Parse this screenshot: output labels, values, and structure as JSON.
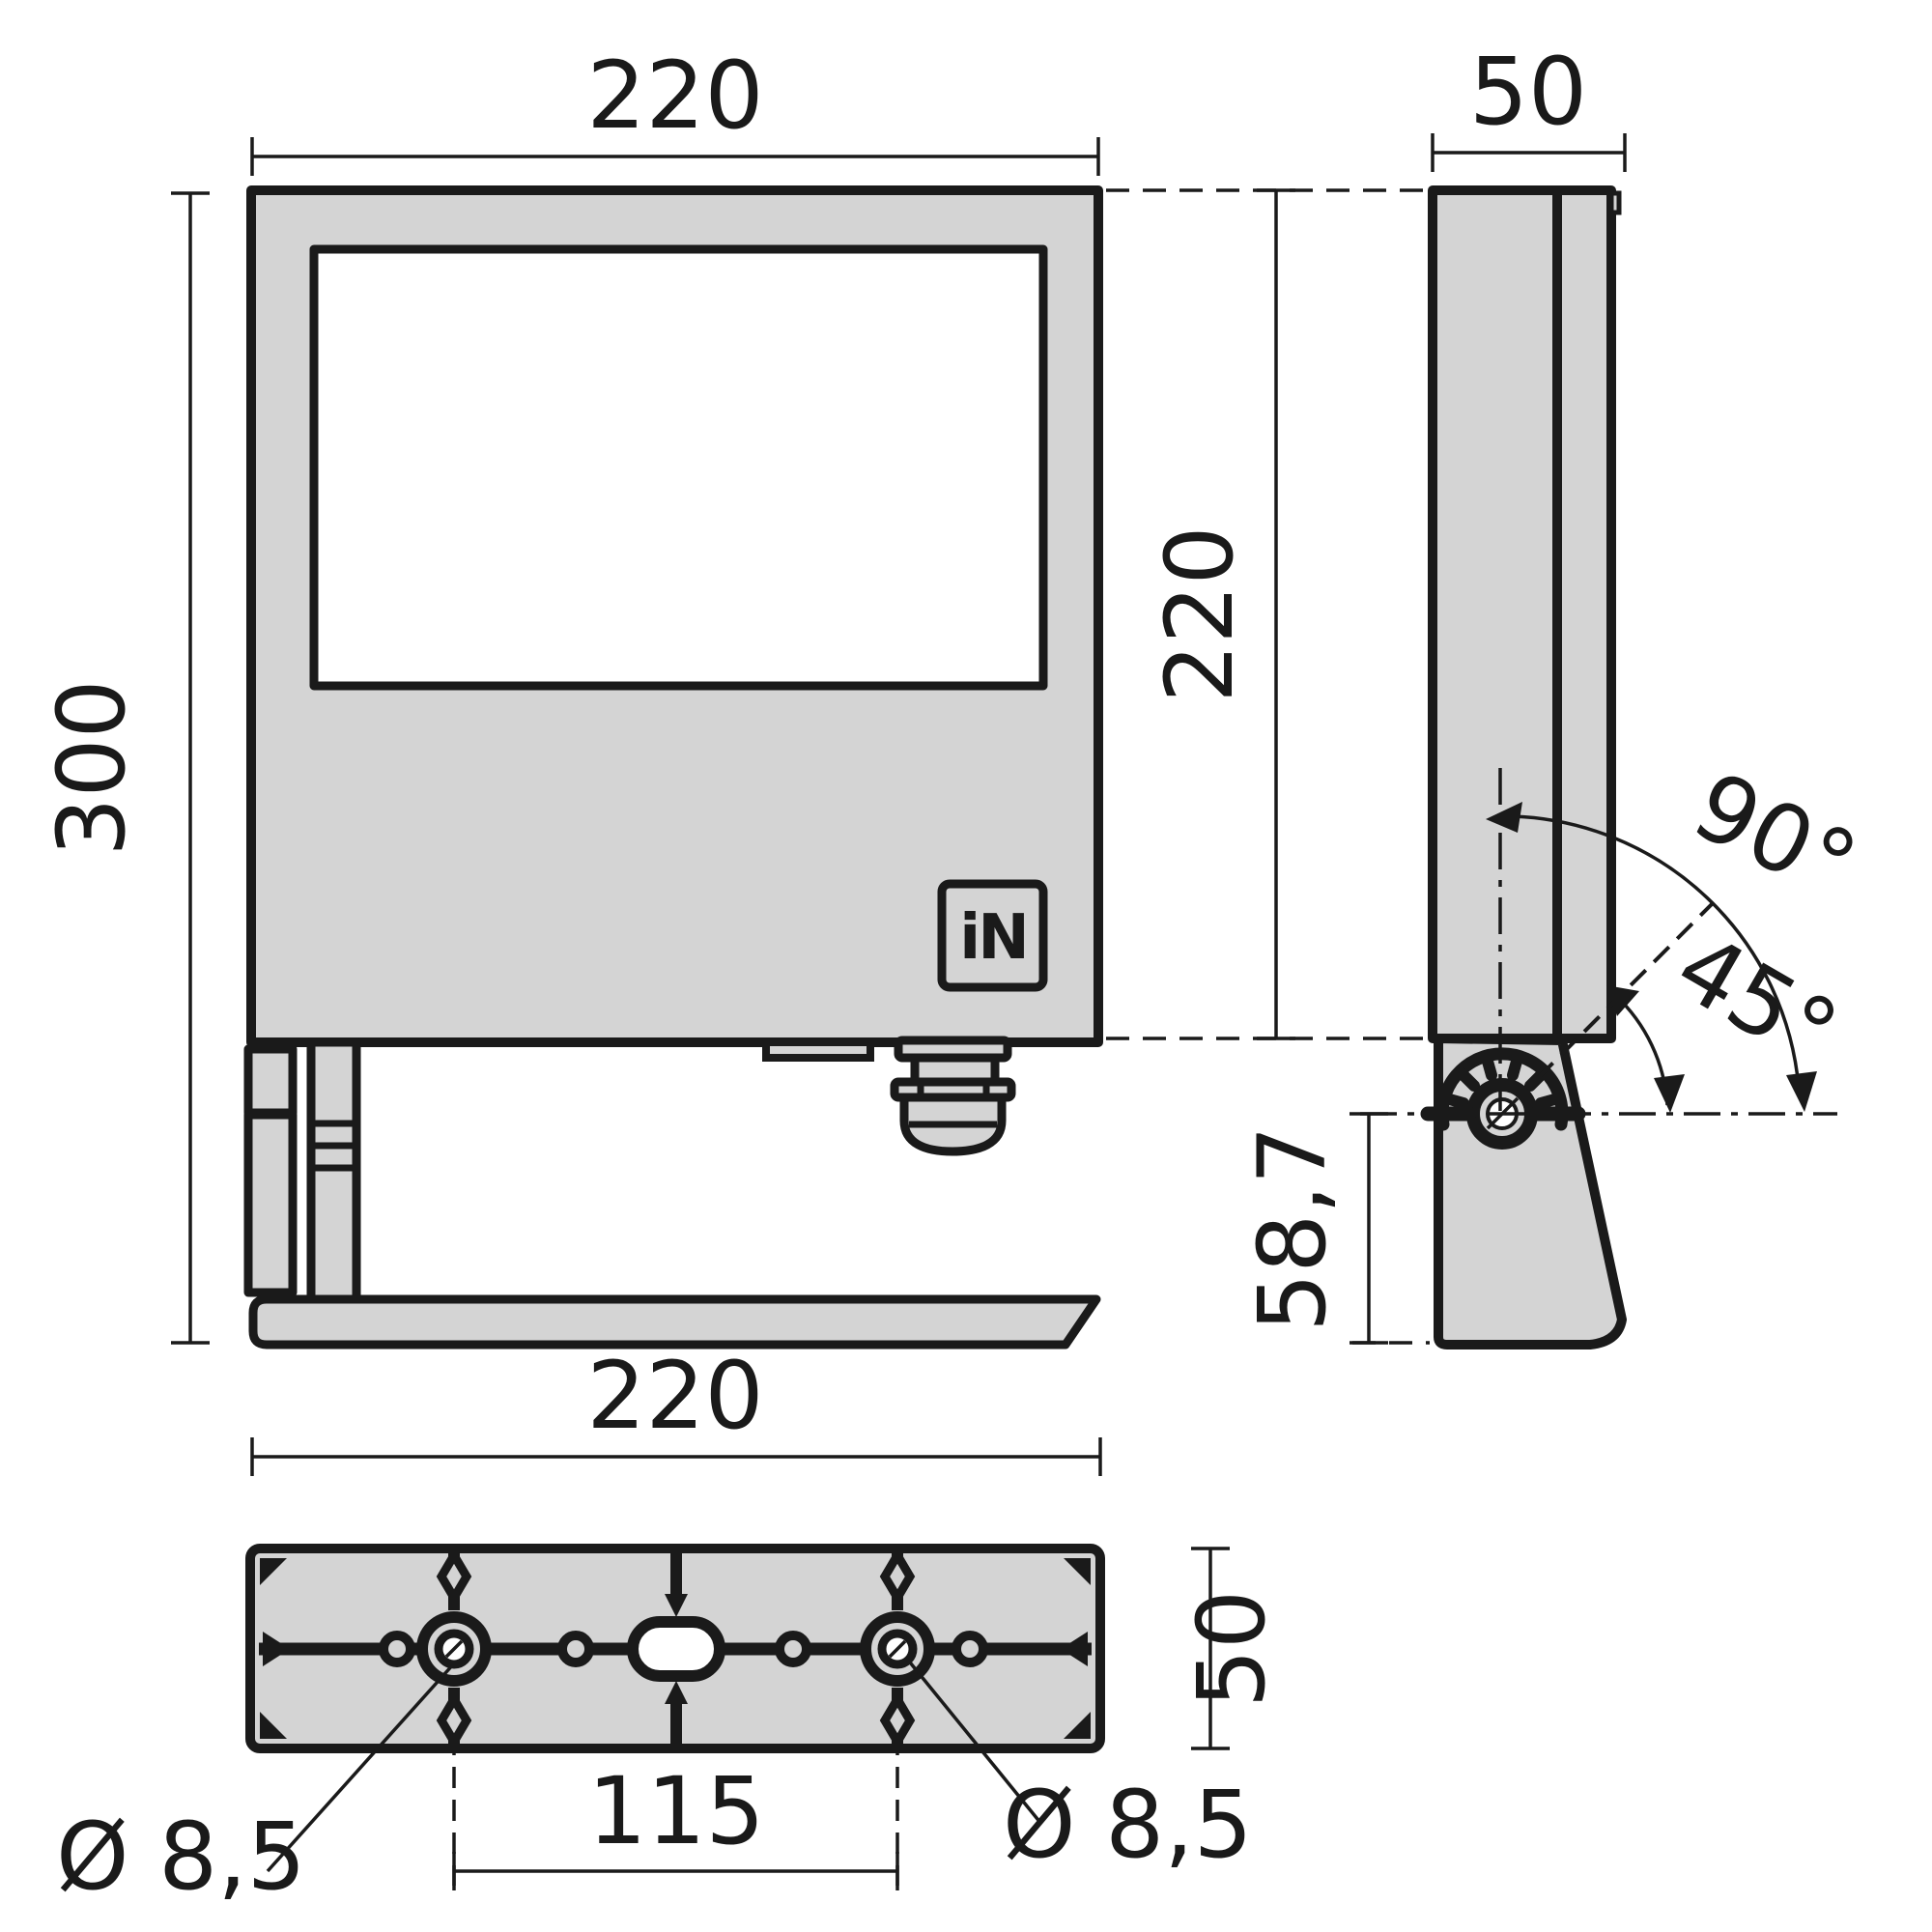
{
  "views": {
    "front": {
      "width": "220",
      "height": "300",
      "logo": "iN"
    },
    "side": {
      "width": "50",
      "height": "220",
      "swivel_angle": "90°",
      "tilt_angle": "45°",
      "pivot_offset": "58,7"
    },
    "bottom": {
      "width": "220",
      "depth": "50",
      "hole_spacing": "115",
      "hole_diameter_left": "Ø 8,5",
      "hole_diameter_right": "Ø 8,5"
    }
  },
  "colors": {
    "line": "#1a1a1a",
    "fill_gray": "#d4d4d4",
    "background": "#ffffff"
  }
}
